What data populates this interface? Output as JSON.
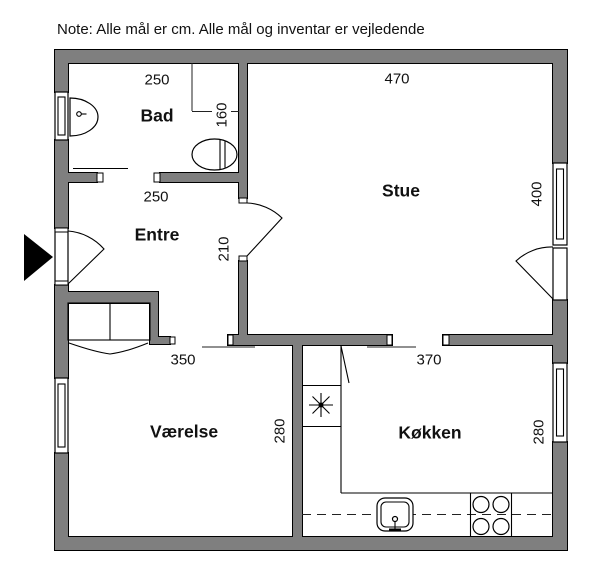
{
  "note": "Note: Alle mål er cm. Alle mål og inventar er vejledende",
  "rooms": {
    "bad": {
      "name": "Bad",
      "width_cm": "250",
      "depth_cm": "160"
    },
    "entre": {
      "name": "Entre",
      "width_cm": "250",
      "wall_cm": "210"
    },
    "stue": {
      "name": "Stue",
      "width_cm": "470",
      "depth_cm": "400"
    },
    "vaerelse": {
      "name": "Værelse",
      "width_cm": "350",
      "depth_cm": "280"
    },
    "koekken": {
      "name": "Køkken",
      "width_cm": "370",
      "depth_cm": "280"
    }
  },
  "fixtures": [
    "entrance-arrow",
    "entrance-door-swing",
    "bathroom-sink",
    "toilet",
    "bathroom-sliding-door",
    "wardrobe",
    "stue-door-swing",
    "terrace-door-swing",
    "water-heater-star",
    "kitchen-counter-dashed-line",
    "kitchen-sink",
    "stove-burners",
    "window-bad",
    "window-vaerelse",
    "window-stue",
    "window-koekken"
  ],
  "colors": {
    "wall_fill": "#7f7f7f",
    "line": "#000000",
    "background": "#ffffff"
  }
}
